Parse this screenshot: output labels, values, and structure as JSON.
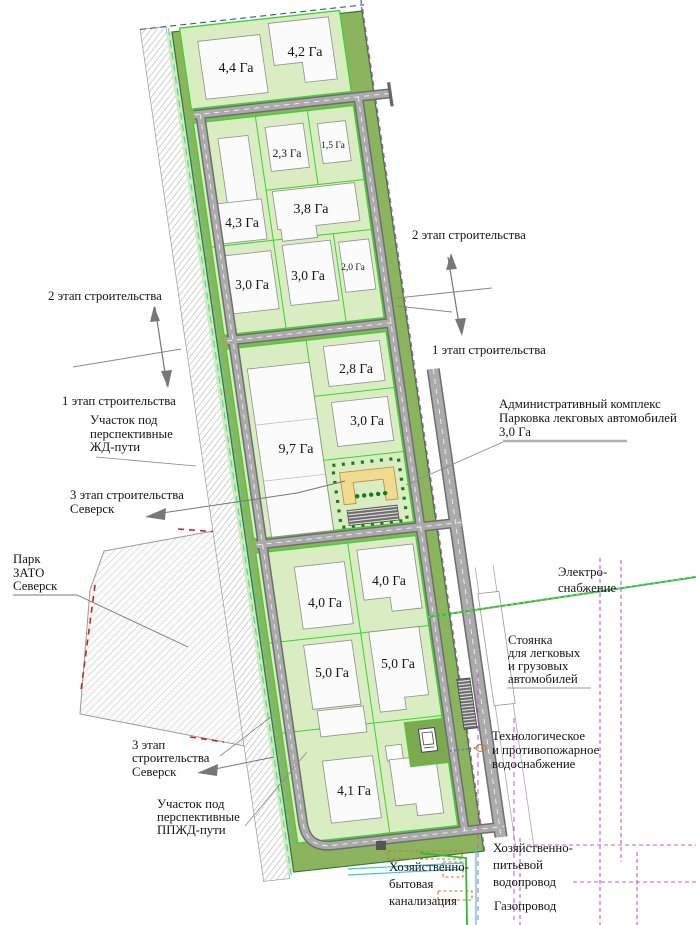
{
  "plots": {
    "p44": "4,4 Га",
    "p42": "4,2 Га",
    "p23": "2,3 Га",
    "p15": "1,5 Га",
    "p43": "4,3 Га",
    "p38": "3,8 Га",
    "p30a": "3,0 Га",
    "p30b": "3,0 Га",
    "p20": "2,0 Га",
    "p28": "2,8 Га",
    "p30c": "3,0 Га",
    "p97": "9,7 Га",
    "p40a": "4,0 Га",
    "p40b": "4,0 Га",
    "p50a": "5,0 Га",
    "p50b": "5,0 Га",
    "p41": "4,1 Га"
  },
  "annotations": {
    "stage2_right": "2 этап строительства",
    "stage1_right": "1 этап строительства",
    "stage2_left": "2 этап строительства",
    "stage1_left": "1 этап строительства",
    "rail_corridor": [
      "Участок под",
      "перспективные",
      "ЖД-пути"
    ],
    "stage3_upper": [
      "3 этап строительства",
      "Северск"
    ],
    "admin": [
      "Административный комплекс",
      "Парковка лекговых автомобилей",
      "3,0 Га"
    ],
    "park": [
      "Парк",
      "ЗАТО",
      "Северск"
    ],
    "electro": [
      "Электро-",
      "снабжение"
    ],
    "parking": [
      "Стоянка",
      "для легковых",
      "и грузовых",
      "автомобилей"
    ],
    "water_tech": [
      "Технологическое",
      "и противопожарное",
      "водоснабжение"
    ],
    "stage3_lower": [
      "3 этап",
      "строительства",
      "Северск"
    ],
    "rail_lower": [
      "Участок под",
      "перспективные",
      "ППЖД-пути"
    ],
    "sewer": [
      "Хозяйственно-",
      "бытовая",
      "канализация"
    ],
    "water_drink": [
      "Хозяйственно-",
      "питьевой",
      "водопровод"
    ],
    "gas": "Газопровод"
  },
  "colors": {
    "site_green": "#8cb45e",
    "panel_green": "#d9ecc2",
    "accent_green": "#3cd42e",
    "dark_green_dots": "#1c7a1c",
    "admin_yellow": "#f1db90",
    "road_gray": "#ababab",
    "boundary_magenta": "#c257c2",
    "utility_purple": "#b564c8",
    "utility_cyan": "#42c4d6",
    "utility_green": "#2eb82e",
    "utility_orange": "#c87820",
    "boundary_blue": "#3a4fae",
    "park_red_dash": "#cc2222"
  }
}
